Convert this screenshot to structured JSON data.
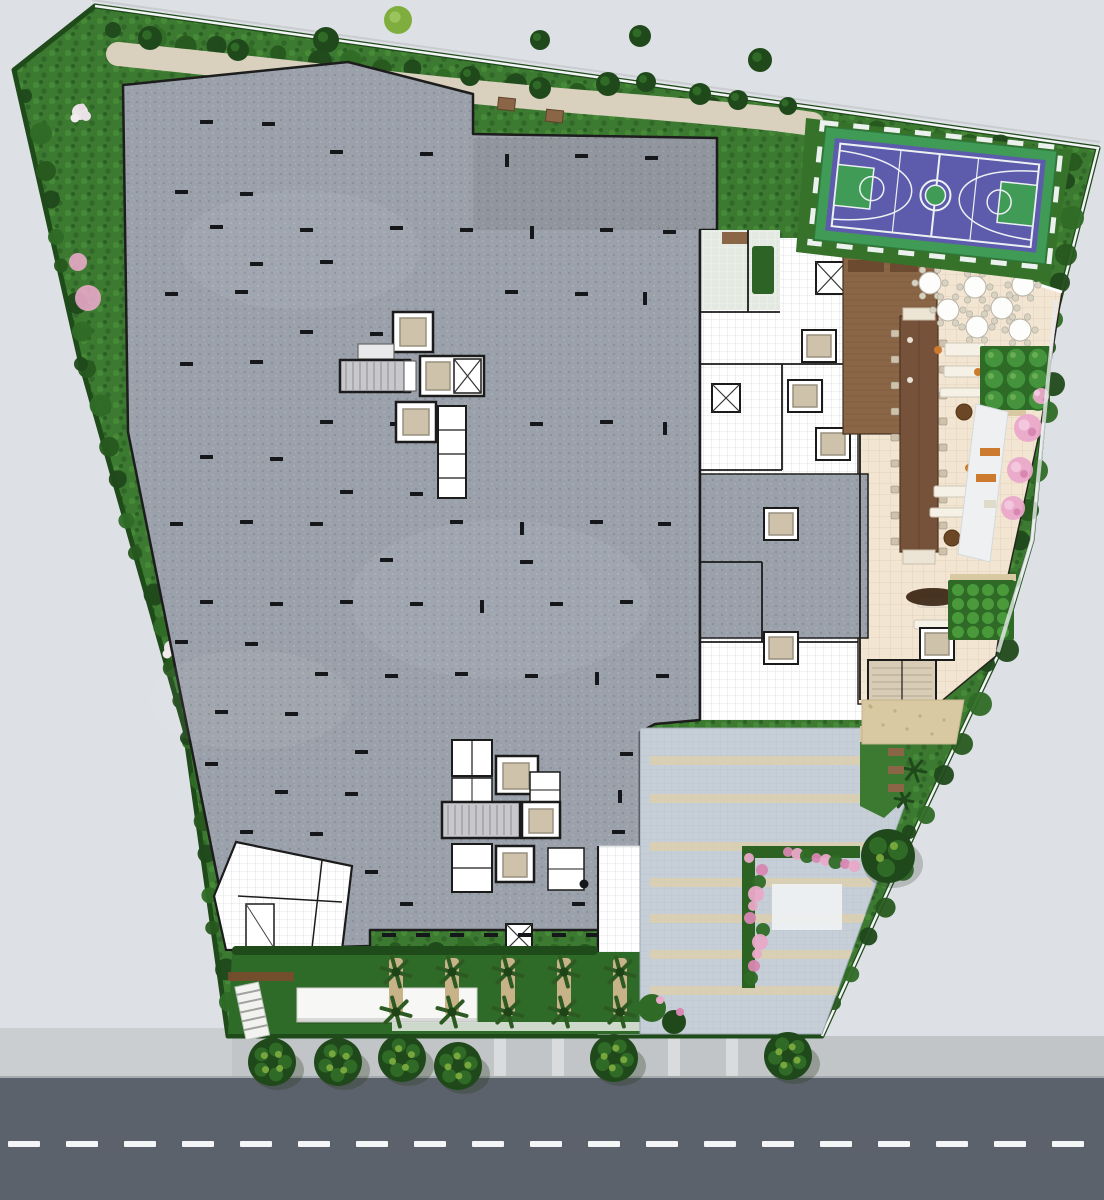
{
  "app": {
    "name": "Ground-floor site plan — aerial architectural rendering",
    "type": "architectural illustration"
  },
  "areas": {
    "road": "Public road",
    "sidewalk": "Street sidewalk",
    "parcel": "Landscaped residential parcel",
    "path": "Perimeter garden path",
    "playground": "Children's playground",
    "slab": "Podium parking roof slab",
    "coreA": "Stair and elevator core A",
    "coreB": "Stair and elevator core B",
    "storage": "Ground-level utility rooms",
    "walkway": "Pedestrian walkway",
    "building": "Amenity building interior",
    "terrace": "Outdoor dining terrace",
    "deck": "Timber deck lounge",
    "bar": "Communal dining bar",
    "lobby": "Residential lobby and grand stair",
    "court": "Multi-sport basketball court",
    "driveway": "Entrance driveway",
    "palms": "Palm garden",
    "parterre": "Clipped shrub parterre",
    "orchard": "Orchard garden",
    "patio": "Garden patio",
    "streetTrees": "Street trees",
    "flowers": "Flowering borders",
    "hedges": "Perimeter hedges"
  },
  "counts": {
    "road_dash_segments": 19,
    "sidewalk_strips": 6,
    "street_trees": 6,
    "palm_trees": 10,
    "dining_tables": 7,
    "clipped_shrubs": 9,
    "orchard_shrubs": 16,
    "driveway_stripes": 7,
    "elevator_cabs": 12,
    "stair_flights": 4
  },
  "palette": {
    "outside": "#dde0e4",
    "road": "#5b626b",
    "roadLine": "#f3f5f6",
    "sidewalk": "#c2c5c8",
    "sidewalkLight": "#cbced1",
    "sidewalkStrip": "#d9dbdd",
    "curb": "#a6abb0",
    "parcelGreen": "#3b7a30",
    "hedge": "#1f4a1a",
    "treeDark": "#20491b",
    "treeMid": "#2f6b26",
    "treeLight": "#7fae3f",
    "gravel": "#d9d1bd",
    "slab": "#9ba1aa",
    "slabEdge": "#1d1d1d",
    "jointBlack": "#15171a",
    "roomWhite": "#ffffff",
    "tileLine": "#d8dbe0",
    "paleTile": "#e4eae2",
    "beige": "#f2e5d2",
    "beigeLine": "#e2d2bc",
    "deck": "#8a6647",
    "deckLine": "#74533a",
    "bar": "#76523a",
    "rug": "#3e2917",
    "stairGray": "#c8c8cc",
    "elevatorCar": "#cfc2ab",
    "wall": "#1b1b1b",
    "courtGreen": "#3f9b56",
    "courtPurple": "#5d5bab",
    "courtLine": "#edf1f4",
    "paver": "#c6cfd7",
    "paverLine": "#b4bfc9",
    "stripe": "#d9cfb2",
    "palmFrond": "#2c5a22",
    "palmDark": "#1d4316",
    "trunk": "#c8b288",
    "pink": "#e9a9c9",
    "pinkDeep": "#d886b2",
    "flowerWhite": "#f2ecef",
    "orange": "#cc7a2e",
    "playRed": "#d93327",
    "playYellow": "#e9c93c",
    "benchBrown": "#8a6647",
    "sand": "#d8c9a2",
    "soil": "#7a4b2e",
    "walk": "#eef0f2",
    "boundaryLine": "#f2f4f6"
  }
}
